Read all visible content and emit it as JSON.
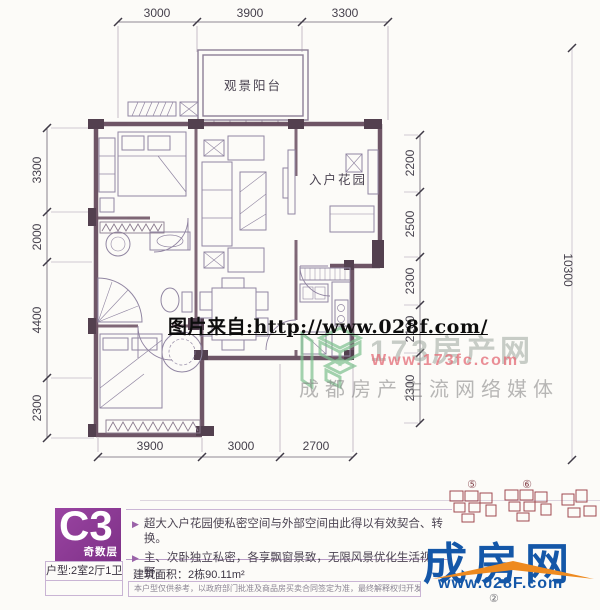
{
  "floorplan": {
    "rooms": {
      "balcony": "观景阳台",
      "entry_garden": "入户花园"
    },
    "dims": {
      "top": [
        "3000",
        "3900",
        "3300"
      ],
      "left": [
        "3300",
        "2000",
        "4400",
        "2300"
      ],
      "right": [
        "2200",
        "2500",
        "2300",
        "2100",
        "2300"
      ],
      "bottom": [
        "3900",
        "3000",
        "2700"
      ],
      "far_right": "10300"
    }
  },
  "watermark": {
    "source_line": "图片来自:http://www.028f.com/",
    "logo": {
      "brand": "173房产网",
      "url": "Www.173fc.com",
      "tagline": "成都房产主流网络媒体"
    }
  },
  "banner": {
    "unit_code": "C3",
    "floor_note": "奇数层",
    "unit_type": "户型:2室2厅1卫",
    "bullet_glyph": "▶",
    "features": [
      "超大入户花园使私密空间与外部空间由此得以有效契合、转换。",
      "主、次卧独立私密，各享飘窗景致，无限风景优化生活视野。"
    ],
    "area": "建筑面积：2栋90.11m²",
    "disclaimer": "本户型仅供参考，以政府部门批准及商品房买卖合同签定为准，最终解释权归开发商所有",
    "keyplan": {
      "labels": [
        "⑤",
        "⑥"
      ]
    }
  },
  "footer_logo": {
    "brand": "成房网",
    "url": "www.028F.com",
    "badge": "②"
  },
  "colors": {
    "wall": "#5e4355",
    "banner_purple": "#8a3894",
    "logo_blue": "#1457a8",
    "logo_orange": "#ee8a1f",
    "keyplan_red": "#a04850",
    "logo_green": "#7cc08e",
    "url_pink": "#e4707a"
  }
}
